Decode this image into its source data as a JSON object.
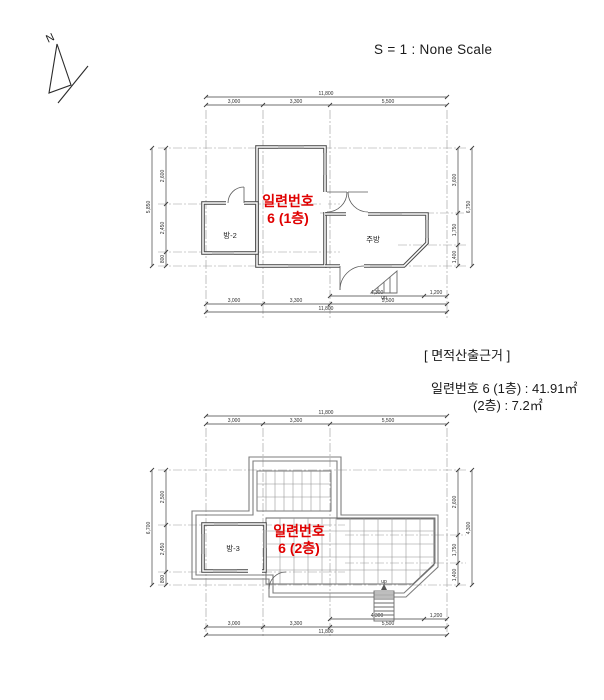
{
  "header": {
    "scale_label": "S = 1 : None Scale",
    "north_label": "N"
  },
  "area_note": {
    "title": "[ 면적산출근거 ]",
    "line1": "일련번호 6 (1층) : 41.91㎡",
    "line2": "(2층) : 7.2㎡"
  },
  "colors": {
    "accent_red": "#e00000",
    "line_gray": "#555555"
  },
  "plan1": {
    "unit_label_line1": "일련번호",
    "unit_label_line2": "6 (1층)",
    "rooms": {
      "room2": "방-2",
      "kitchen": "주방"
    },
    "dims": {
      "top": {
        "total": "11,800",
        "segments": [
          "3,000",
          "3,300",
          "5,500"
        ]
      },
      "bottom": {
        "row1": [
          "4,300",
          "1,200"
        ],
        "row2": [
          "3,000",
          "3,300",
          "5,500"
        ],
        "total": "11,800"
      },
      "left": {
        "segments": [
          "2,600",
          "2,450",
          "800"
        ],
        "total": "5,850"
      },
      "right": {
        "segments": [
          "3,600",
          "1,750",
          "1,400"
        ],
        "total": "6,750"
      }
    },
    "stairs_label": "up"
  },
  "plan2": {
    "unit_label_line1": "일련번호",
    "unit_label_line2": "6 (2층)",
    "rooms": {
      "room3": "방-3"
    },
    "dims": {
      "top": {
        "total": "11,800",
        "segments": [
          "3,000",
          "3,300",
          "5,500"
        ]
      },
      "bottom": {
        "row1": [
          "4,300",
          "1,200"
        ],
        "row2": [
          "3,000",
          "3,300",
          "5,500"
        ],
        "total": "11,800"
      },
      "left": {
        "segments": [
          "2,500",
          "2,450",
          "800"
        ],
        "total": "6,700"
      },
      "right": {
        "segments": [
          "2,600",
          "1,750",
          "1,400"
        ],
        "total": "4,300"
      }
    },
    "stairs_label": "up"
  }
}
